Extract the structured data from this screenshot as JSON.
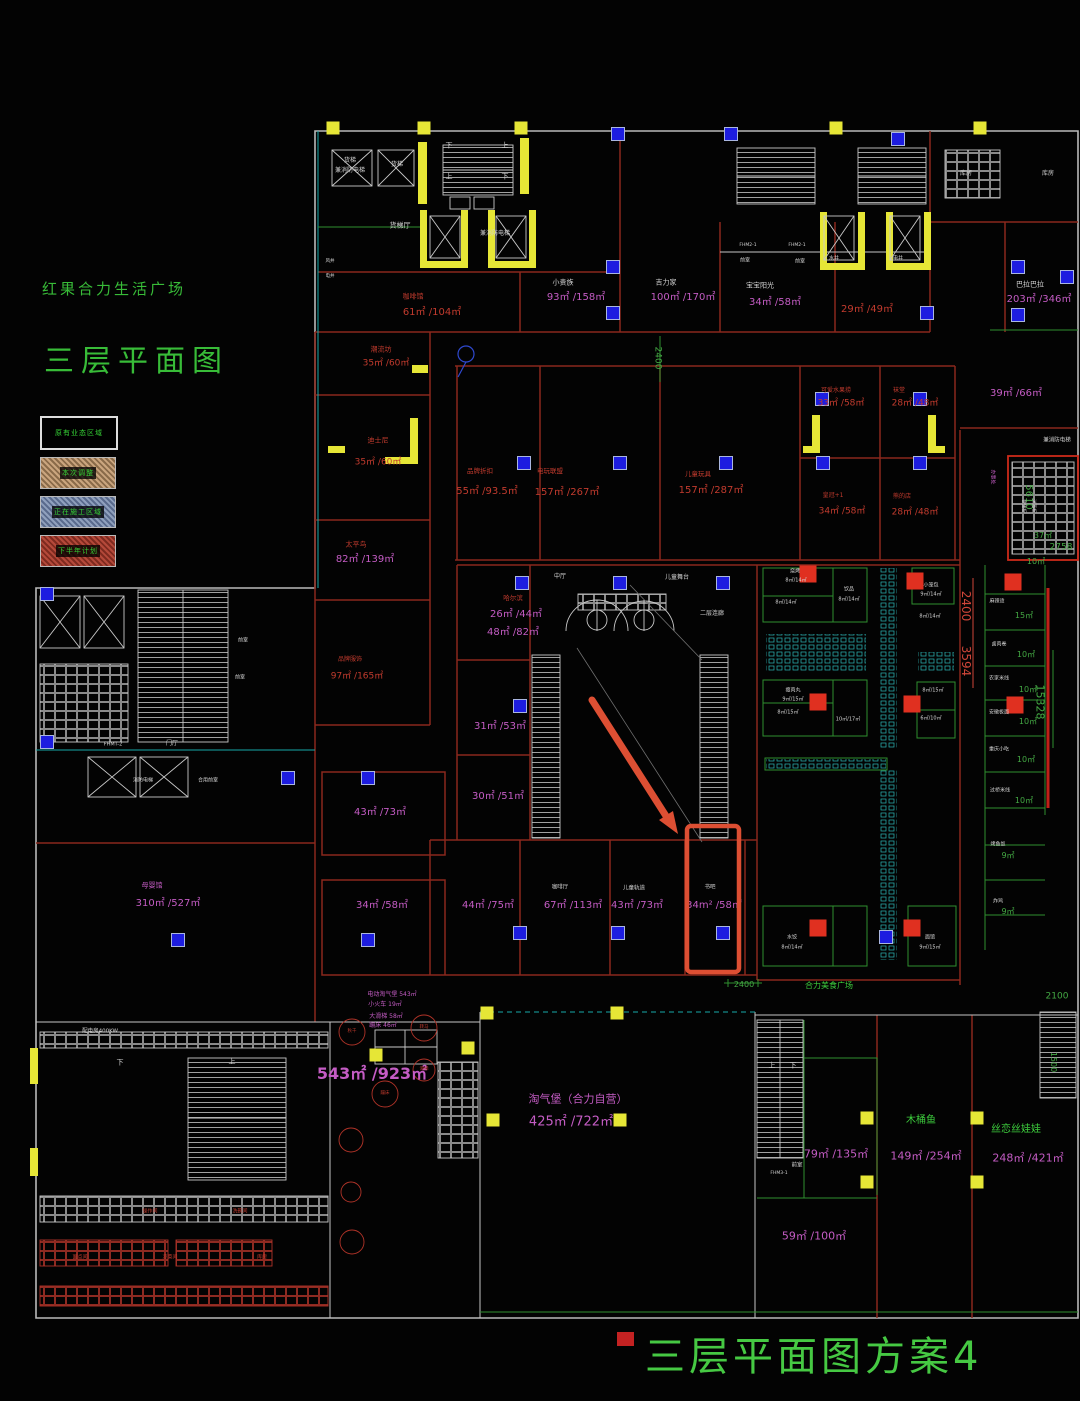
{
  "titles": {
    "project": "红果合力生活广场",
    "sheet": "三层平面图",
    "plan_name": "三层平面图方案4"
  },
  "legend": {
    "header": "原有业态区域",
    "items": [
      {
        "label": "本次调整",
        "style": "tan"
      },
      {
        "label": "正在施工区域",
        "style": "blue"
      },
      {
        "label": "下半年计划",
        "style": "red"
      }
    ]
  },
  "annotation": {
    "color": "#dd4f33",
    "arrow": {
      "x1": 592,
      "y1": 700,
      "x2": 666,
      "y2": 816
    },
    "head_points": "678,834 659,820 673,811",
    "box": {
      "x": 687,
      "y": 826,
      "w": 52,
      "h": 146
    },
    "highlighted_room": {
      "label": "书吧",
      "area": "34m²/58㎡"
    }
  },
  "colors": {
    "magenta": "#c45cc4",
    "red_text": "#c23b2e",
    "green_text": "#3ecf3e",
    "dim_green": "#44a944",
    "white_text": "#d5d5d5",
    "dim_red": "#cf4639",
    "wall_red": "#8a281c",
    "yellow": "#e6e636",
    "column_blue": "#1d1de0"
  },
  "labels": [
    {
      "t": "货梯",
      "x": 350,
      "y": 161,
      "c": "w",
      "s": 6
    },
    {
      "t": "兼消防电梯",
      "x": 350,
      "y": 171,
      "c": "w",
      "s": 6
    },
    {
      "t": "货梯",
      "x": 397,
      "y": 165,
      "c": "w",
      "s": 6
    },
    {
      "t": "货梯厅",
      "x": 400,
      "y": 226,
      "c": "w",
      "s": 7
    },
    {
      "t": "兼消防电梯",
      "x": 495,
      "y": 234,
      "c": "w",
      "s": 6
    },
    {
      "t": "下",
      "x": 449,
      "y": 146,
      "c": "w",
      "s": 7
    },
    {
      "t": "上",
      "x": 505,
      "y": 146,
      "c": "w",
      "s": 7
    },
    {
      "t": "上",
      "x": 449,
      "y": 177,
      "c": "w",
      "s": 7
    },
    {
      "t": "下",
      "x": 505,
      "y": 177,
      "c": "w",
      "s": 7
    },
    {
      "t": "咖啡馆",
      "x": 413,
      "y": 297,
      "c": "r",
      "s": 7
    },
    {
      "t": "61㎡ /104㎡",
      "x": 432,
      "y": 313,
      "c": "r",
      "s": 10
    },
    {
      "t": "小贵族",
      "x": 563,
      "y": 283,
      "c": "w",
      "s": 7
    },
    {
      "t": "93㎡ /158㎡",
      "x": 576,
      "y": 298,
      "c": "m",
      "s": 10
    },
    {
      "t": "吉力家",
      "x": 666,
      "y": 283,
      "c": "w",
      "s": 7
    },
    {
      "t": "100㎡ /170㎡",
      "x": 683,
      "y": 298,
      "c": "m",
      "s": 10
    },
    {
      "t": "宝宝阳光",
      "x": 760,
      "y": 286,
      "c": "w",
      "s": 7
    },
    {
      "t": "34㎡ /58㎡",
      "x": 775,
      "y": 303,
      "c": "m",
      "s": 10
    },
    {
      "t": "29㎡ /49㎡",
      "x": 867,
      "y": 310,
      "c": "r",
      "s": 10
    },
    {
      "t": "巴拉巴拉",
      "x": 1030,
      "y": 285,
      "c": "w",
      "s": 7
    },
    {
      "t": "203㎡ /346㎡",
      "x": 1039,
      "y": 300,
      "c": "m",
      "s": 10
    },
    {
      "t": "前室",
      "x": 745,
      "y": 261,
      "c": "w",
      "s": 5
    },
    {
      "t": "前室",
      "x": 800,
      "y": 262,
      "c": "w",
      "s": 5
    },
    {
      "t": "水井",
      "x": 834,
      "y": 259,
      "c": "w",
      "s": 5
    },
    {
      "t": "电井",
      "x": 898,
      "y": 259,
      "c": "w",
      "s": 5
    },
    {
      "t": "FHM2-1",
      "x": 748,
      "y": 246,
      "c": "w",
      "s": 4.5
    },
    {
      "t": "FHM2-1",
      "x": 797,
      "y": 246,
      "c": "w",
      "s": 4.5
    },
    {
      "t": "库房",
      "x": 966,
      "y": 174,
      "c": "w",
      "s": 6
    },
    {
      "t": "库房",
      "x": 1048,
      "y": 174,
      "c": "w",
      "s": 6
    },
    {
      "t": "潮流坊",
      "x": 381,
      "y": 350,
      "c": "r",
      "s": 7
    },
    {
      "t": "35㎡ /60㎡",
      "x": 386,
      "y": 364,
      "c": "r",
      "s": 9
    },
    {
      "t": "迪士尼",
      "x": 378,
      "y": 441,
      "c": "r",
      "s": 7
    },
    {
      "t": "35㎡ /60㎡",
      "x": 378,
      "y": 463,
      "c": "r",
      "s": 9
    },
    {
      "t": "太平鸟",
      "x": 356,
      "y": 545,
      "c": "r",
      "s": 7
    },
    {
      "t": "82㎡ /139㎡",
      "x": 365,
      "y": 560,
      "c": "m",
      "s": 10
    },
    {
      "t": "品牌折扣",
      "x": 480,
      "y": 471,
      "c": "r",
      "s": 6.5
    },
    {
      "t": "55㎡ /93.5㎡",
      "x": 487,
      "y": 492,
      "c": "r",
      "s": 10
    },
    {
      "t": "电玩联盟",
      "x": 550,
      "y": 471,
      "c": "r",
      "s": 6.5
    },
    {
      "t": "157㎡ /267㎡",
      "x": 567,
      "y": 493,
      "c": "r",
      "s": 10
    },
    {
      "t": "儿童玩具",
      "x": 698,
      "y": 474,
      "c": "r",
      "s": 6.5
    },
    {
      "t": "157㎡ /287㎡",
      "x": 711,
      "y": 491,
      "c": "r",
      "s": 10
    },
    {
      "t": "可爱水果捞",
      "x": 836,
      "y": 391,
      "c": "r",
      "s": 6
    },
    {
      "t": "33㎡ /58㎡",
      "x": 841,
      "y": 404,
      "c": "r",
      "s": 9
    },
    {
      "t": "袜堂",
      "x": 899,
      "y": 391,
      "c": "r",
      "s": 6
    },
    {
      "t": "28㎡ /48㎡",
      "x": 915,
      "y": 404,
      "c": "r",
      "s": 9
    },
    {
      "t": "皇冠+1",
      "x": 833,
      "y": 496,
      "c": "r",
      "s": 6
    },
    {
      "t": "34㎡ /58㎡",
      "x": 842,
      "y": 512,
      "c": "r",
      "s": 9
    },
    {
      "t": "熊的店",
      "x": 902,
      "y": 497,
      "c": "r",
      "s": 6
    },
    {
      "t": "28㎡ /48㎡",
      "x": 915,
      "y": 513,
      "c": "r",
      "s": 9
    },
    {
      "t": "39㎡ /66㎡",
      "x": 1016,
      "y": 394,
      "c": "m",
      "s": 10
    },
    {
      "t": "兼消防电梯",
      "x": 1057,
      "y": 441,
      "c": "w",
      "s": 5.5
    },
    {
      "t": "5610",
      "x": 1028,
      "y": 497,
      "c": "dg",
      "s": 10,
      "r": 1
    },
    {
      "t": "37㎡",
      "x": 1043,
      "y": 536,
      "c": "dg",
      "s": 8
    },
    {
      "t": "2758",
      "x": 1061,
      "y": 548,
      "c": "dg",
      "s": 9
    },
    {
      "t": "10㎡",
      "x": 1036,
      "y": 562,
      "c": "dg",
      "s": 8
    },
    {
      "t": "办事处",
      "x": 992,
      "y": 477,
      "c": "m",
      "s": 5,
      "r": 1
    },
    {
      "t": "快递柜",
      "x": 1022,
      "y": 506,
      "c": "w",
      "s": 4.5,
      "r": 1
    },
    {
      "t": "消毒柜",
      "x": 1032,
      "y": 506,
      "c": "w",
      "s": 4.5,
      "r": 1
    },
    {
      "t": "哈尔滨",
      "x": 513,
      "y": 598,
      "c": "r",
      "s": 6.5
    },
    {
      "t": "26㎡ /44㎡",
      "x": 516,
      "y": 615,
      "c": "m",
      "s": 10
    },
    {
      "t": "48㎡ /82㎡",
      "x": 513,
      "y": 633,
      "c": "m",
      "s": 10
    },
    {
      "t": "中厅",
      "x": 560,
      "y": 577,
      "c": "w",
      "s": 6
    },
    {
      "t": "儿童舞台",
      "x": 677,
      "y": 578,
      "c": "w",
      "s": 6
    },
    {
      "t": "二层连廊",
      "x": 712,
      "y": 614,
      "c": "w",
      "s": 6
    },
    {
      "t": "31㎡ /53㎡",
      "x": 500,
      "y": 727,
      "c": "m",
      "s": 10
    },
    {
      "t": "30㎡ /51㎡",
      "x": 498,
      "y": 797,
      "c": "m",
      "s": 10
    },
    {
      "t": "43㎡ /73㎡",
      "x": 380,
      "y": 813,
      "c": "m",
      "s": 10
    },
    {
      "t": "34㎡ /58㎡",
      "x": 382,
      "y": 906,
      "c": "m",
      "s": 10
    },
    {
      "t": "品牌服饰",
      "x": 350,
      "y": 660,
      "c": "r",
      "s": 6
    },
    {
      "t": "97㎡ /165㎡",
      "x": 357,
      "y": 677,
      "c": "r",
      "s": 9
    },
    {
      "t": "母婴馆",
      "x": 152,
      "y": 886,
      "c": "m",
      "s": 7
    },
    {
      "t": "310㎡ /527㎡",
      "x": 168,
      "y": 904,
      "c": "m",
      "s": 10
    },
    {
      "t": "FHMT-2",
      "x": 113,
      "y": 745,
      "c": "w",
      "s": 5
    },
    {
      "t": "门厅",
      "x": 172,
      "y": 744,
      "c": "w",
      "s": 6
    },
    {
      "t": "前室",
      "x": 243,
      "y": 641,
      "c": "w",
      "s": 5
    },
    {
      "t": "前室",
      "x": 240,
      "y": 678,
      "c": "w",
      "s": 5
    },
    {
      "t": "消防电梯",
      "x": 143,
      "y": 781,
      "c": "w",
      "s": 5
    },
    {
      "t": "合用前室",
      "x": 208,
      "y": 781,
      "c": "w",
      "s": 5
    },
    {
      "t": "44㎡ /75㎡",
      "x": 488,
      "y": 906,
      "c": "m",
      "s": 10
    },
    {
      "t": "咖啡厅",
      "x": 560,
      "y": 888,
      "c": "w",
      "s": 5.5
    },
    {
      "t": "67㎡ /113㎡",
      "x": 573,
      "y": 906,
      "c": "m",
      "s": 10
    },
    {
      "t": "儿童轨道",
      "x": 634,
      "y": 889,
      "c": "w",
      "s": 5.5
    },
    {
      "t": "43㎡ /73㎡",
      "x": 637,
      "y": 906,
      "c": "m",
      "s": 10
    },
    {
      "t": "书吧",
      "x": 710,
      "y": 888,
      "c": "w",
      "s": 5.5
    },
    {
      "t": "34m² /58㎡",
      "x": 714,
      "y": 906,
      "c": "m",
      "s": 10
    },
    {
      "t": "2400",
      "x": 966,
      "y": 606,
      "c": "dr",
      "s": 12,
      "r": 1
    },
    {
      "t": "3594",
      "x": 966,
      "y": 661,
      "c": "dr",
      "s": 12,
      "r": 1
    },
    {
      "t": "15328",
      "x": 1040,
      "y": 702,
      "c": "dg",
      "s": 11,
      "r": 1
    },
    {
      "t": "合力美食广场",
      "x": 829,
      "y": 986,
      "c": "g",
      "s": 8
    },
    {
      "t": "2400",
      "x": 744,
      "y": 985,
      "c": "dg",
      "s": 8
    },
    {
      "t": "2100",
      "x": 1057,
      "y": 997,
      "c": "dg",
      "s": 9
    },
    {
      "t": "1500",
      "x": 1053,
      "y": 1062,
      "c": "dg",
      "s": 8,
      "r": 1
    },
    {
      "t": "2400",
      "x": 657,
      "y": 358,
      "c": "dg",
      "s": 9,
      "r": 1
    },
    {
      "t": "风井",
      "x": 330,
      "y": 262,
      "c": "w",
      "s": 4.5
    },
    {
      "t": "电井",
      "x": 330,
      "y": 277,
      "c": "w",
      "s": 4.5
    },
    {
      "t": "麻辣烫",
      "x": 997,
      "y": 602,
      "c": "w",
      "s": 5
    },
    {
      "t": "15㎡",
      "x": 1024,
      "y": 616,
      "c": "dg",
      "s": 8
    },
    {
      "t": "卤肉卷",
      "x": 999,
      "y": 645,
      "c": "w",
      "s": 5
    },
    {
      "t": "10㎡",
      "x": 1026,
      "y": 655,
      "c": "dg",
      "s": 8
    },
    {
      "t": "农家米线",
      "x": 999,
      "y": 679,
      "c": "w",
      "s": 5
    },
    {
      "t": "10㎡",
      "x": 1028,
      "y": 690,
      "c": "dg",
      "s": 8
    },
    {
      "t": "安徽板面",
      "x": 999,
      "y": 713,
      "c": "w",
      "s": 5
    },
    {
      "t": "10㎡",
      "x": 1028,
      "y": 722,
      "c": "dg",
      "s": 8
    },
    {
      "t": "重庆小吃",
      "x": 999,
      "y": 750,
      "c": "w",
      "s": 5
    },
    {
      "t": "10㎡",
      "x": 1026,
      "y": 760,
      "c": "dg",
      "s": 8
    },
    {
      "t": "过桥米线",
      "x": 1000,
      "y": 791,
      "c": "w",
      "s": 5
    },
    {
      "t": "10㎡",
      "x": 1024,
      "y": 801,
      "c": "dg",
      "s": 8
    },
    {
      "t": "烤鱼饭",
      "x": 998,
      "y": 845,
      "c": "w",
      "s": 5
    },
    {
      "t": "9㎡",
      "x": 1008,
      "y": 856,
      "c": "dg",
      "s": 8
    },
    {
      "t": "炸鸡",
      "x": 998,
      "y": 902,
      "c": "w",
      "s": 5
    },
    {
      "t": "9㎡",
      "x": 1008,
      "y": 912,
      "c": "dg",
      "s": 8
    },
    {
      "t": "烧烤",
      "x": 795,
      "y": 572,
      "c": "w",
      "s": 5
    },
    {
      "t": "8㎡/14㎡",
      "x": 796,
      "y": 581,
      "c": "w",
      "s": 5
    },
    {
      "t": "8㎡/14㎡",
      "x": 786,
      "y": 603,
      "c": "w",
      "s": 5
    },
    {
      "t": "饮品",
      "x": 849,
      "y": 590,
      "c": "w",
      "s": 5
    },
    {
      "t": "8㎡/14㎡",
      "x": 849,
      "y": 600,
      "c": "w",
      "s": 5
    },
    {
      "t": "小笼包",
      "x": 931,
      "y": 586,
      "c": "w",
      "s": 5
    },
    {
      "t": "9㎡/14㎡",
      "x": 931,
      "y": 595,
      "c": "w",
      "s": 5
    },
    {
      "t": "8㎡/14㎡",
      "x": 930,
      "y": 617,
      "c": "w",
      "s": 5
    },
    {
      "t": "瘦肉丸",
      "x": 793,
      "y": 691,
      "c": "w",
      "s": 5
    },
    {
      "t": "9㎡/15㎡",
      "x": 793,
      "y": 700,
      "c": "w",
      "s": 5
    },
    {
      "t": "8㎡/15㎡",
      "x": 788,
      "y": 713,
      "c": "w",
      "s": 5
    },
    {
      "t": "10㎡/17㎡",
      "x": 848,
      "y": 720,
      "c": "w",
      "s": 5
    },
    {
      "t": "8㎡/15㎡",
      "x": 933,
      "y": 691,
      "c": "w",
      "s": 5
    },
    {
      "t": "6㎡/10㎡",
      "x": 931,
      "y": 719,
      "c": "w",
      "s": 5
    },
    {
      "t": "水饺",
      "x": 792,
      "y": 938,
      "c": "w",
      "s": 5
    },
    {
      "t": "8㎡/14㎡",
      "x": 792,
      "y": 948,
      "c": "w",
      "s": 5
    },
    {
      "t": "面馆",
      "x": 930,
      "y": 938,
      "c": "w",
      "s": 5
    },
    {
      "t": "9㎡/15㎡",
      "x": 930,
      "y": 948,
      "c": "w",
      "s": 5
    },
    {
      "t": "电动淘气堡 543㎡",
      "x": 392,
      "y": 995,
      "c": "m",
      "s": 6
    },
    {
      "t": "小火车 19㎡",
      "x": 385,
      "y": 1005,
      "c": "m",
      "s": 6
    },
    {
      "t": "大滑梯 58㎡",
      "x": 386,
      "y": 1017,
      "c": "m",
      "s": 6
    },
    {
      "t": "蹦床 46㎡",
      "x": 383,
      "y": 1026,
      "c": "m",
      "s": 6
    },
    {
      "t": "543㎡ /923㎡",
      "x": 372,
      "y": 1074,
      "c": "m",
      "s": 16,
      "b": 1
    },
    {
      "t": "秋千",
      "x": 352,
      "y": 1032,
      "c": "r",
      "s": 4.5
    },
    {
      "t": "转马",
      "x": 424,
      "y": 1028,
      "c": "r",
      "s": 4.5
    },
    {
      "t": "滑梯",
      "x": 424,
      "y": 1070,
      "c": "r",
      "s": 4.5
    },
    {
      "t": "蹦床",
      "x": 385,
      "y": 1094,
      "c": "r",
      "s": 4.5
    },
    {
      "t": "淘气堡（合力自营）",
      "x": 578,
      "y": 1099,
      "c": "m",
      "s": 11
    },
    {
      "t": "425㎡ /722㎡",
      "x": 571,
      "y": 1122,
      "c": "m",
      "s": 13
    },
    {
      "t": "79㎡ /135㎡",
      "x": 836,
      "y": 1154,
      "c": "m",
      "s": 11
    },
    {
      "t": "木桶鱼",
      "x": 921,
      "y": 1121,
      "c": "g",
      "s": 10
    },
    {
      "t": "149㎡ /254㎡",
      "x": 926,
      "y": 1156,
      "c": "m",
      "s": 11
    },
    {
      "t": "丝恋丝娃娃",
      "x": 1016,
      "y": 1130,
      "c": "g",
      "s": 10
    },
    {
      "t": "248㎡ /421㎡",
      "x": 1028,
      "y": 1158,
      "c": "m",
      "s": 11
    },
    {
      "t": "59㎡ /100㎡",
      "x": 814,
      "y": 1236,
      "c": "m",
      "s": 11
    },
    {
      "t": "前室",
      "x": 797,
      "y": 1166,
      "c": "w",
      "s": 5.5
    },
    {
      "t": "FHM3-1",
      "x": 779,
      "y": 1174,
      "c": "w",
      "s": 4.5
    },
    {
      "t": "上",
      "x": 772,
      "y": 1066,
      "c": "w",
      "s": 7
    },
    {
      "t": "下",
      "x": 793,
      "y": 1066,
      "c": "w",
      "s": 7
    },
    {
      "t": "配电房400KW",
      "x": 100,
      "y": 1032,
      "c": "w",
      "s": 5.5
    },
    {
      "t": "上",
      "x": 232,
      "y": 1062,
      "c": "w",
      "s": 7
    },
    {
      "t": "下",
      "x": 120,
      "y": 1063,
      "c": "w",
      "s": 7
    },
    {
      "t": "操作间",
      "x": 150,
      "y": 1212,
      "c": "r",
      "s": 5
    },
    {
      "t": "洗碗间",
      "x": 240,
      "y": 1212,
      "c": "r",
      "s": 5
    },
    {
      "t": "面点间",
      "x": 80,
      "y": 1258,
      "c": "r",
      "s": 5
    },
    {
      "t": "凉菜间",
      "x": 170,
      "y": 1258,
      "c": "r",
      "s": 5
    },
    {
      "t": "库房",
      "x": 262,
      "y": 1258,
      "c": "r",
      "s": 5
    }
  ],
  "columns_blue": [
    [
      618,
      134
    ],
    [
      731,
      134
    ],
    [
      898,
      139
    ],
    [
      613,
      267
    ],
    [
      613,
      313
    ],
    [
      927,
      313
    ],
    [
      1018,
      267
    ],
    [
      1067,
      277
    ],
    [
      1018,
      315
    ],
    [
      822,
      399
    ],
    [
      920,
      399
    ],
    [
      524,
      463
    ],
    [
      620,
      463
    ],
    [
      726,
      463
    ],
    [
      823,
      463
    ],
    [
      920,
      463
    ],
    [
      522,
      583
    ],
    [
      620,
      583
    ],
    [
      723,
      583
    ],
    [
      520,
      706
    ],
    [
      368,
      778
    ],
    [
      288,
      778
    ],
    [
      368,
      940
    ],
    [
      520,
      933
    ],
    [
      618,
      933
    ],
    [
      723,
      933
    ],
    [
      886,
      937
    ],
    [
      178,
      940
    ],
    [
      47,
      594
    ],
    [
      47,
      742
    ]
  ],
  "markers_yellow": [
    [
      333,
      128
    ],
    [
      424,
      128
    ],
    [
      521,
      128
    ],
    [
      836,
      128
    ],
    [
      980,
      128
    ],
    [
      487,
      1013
    ],
    [
      617,
      1013
    ],
    [
      493,
      1120
    ],
    [
      620,
      1120
    ],
    [
      867,
      1118
    ],
    [
      977,
      1118
    ],
    [
      867,
      1182
    ],
    [
      977,
      1182
    ],
    [
      376,
      1055
    ],
    [
      468,
      1048
    ]
  ],
  "stalls_red": [
    [
      808,
      574
    ],
    [
      915,
      581
    ],
    [
      818,
      702
    ],
    [
      912,
      704
    ],
    [
      1013,
      582
    ],
    [
      1015,
      705
    ],
    [
      818,
      928
    ],
    [
      912,
      928
    ]
  ]
}
